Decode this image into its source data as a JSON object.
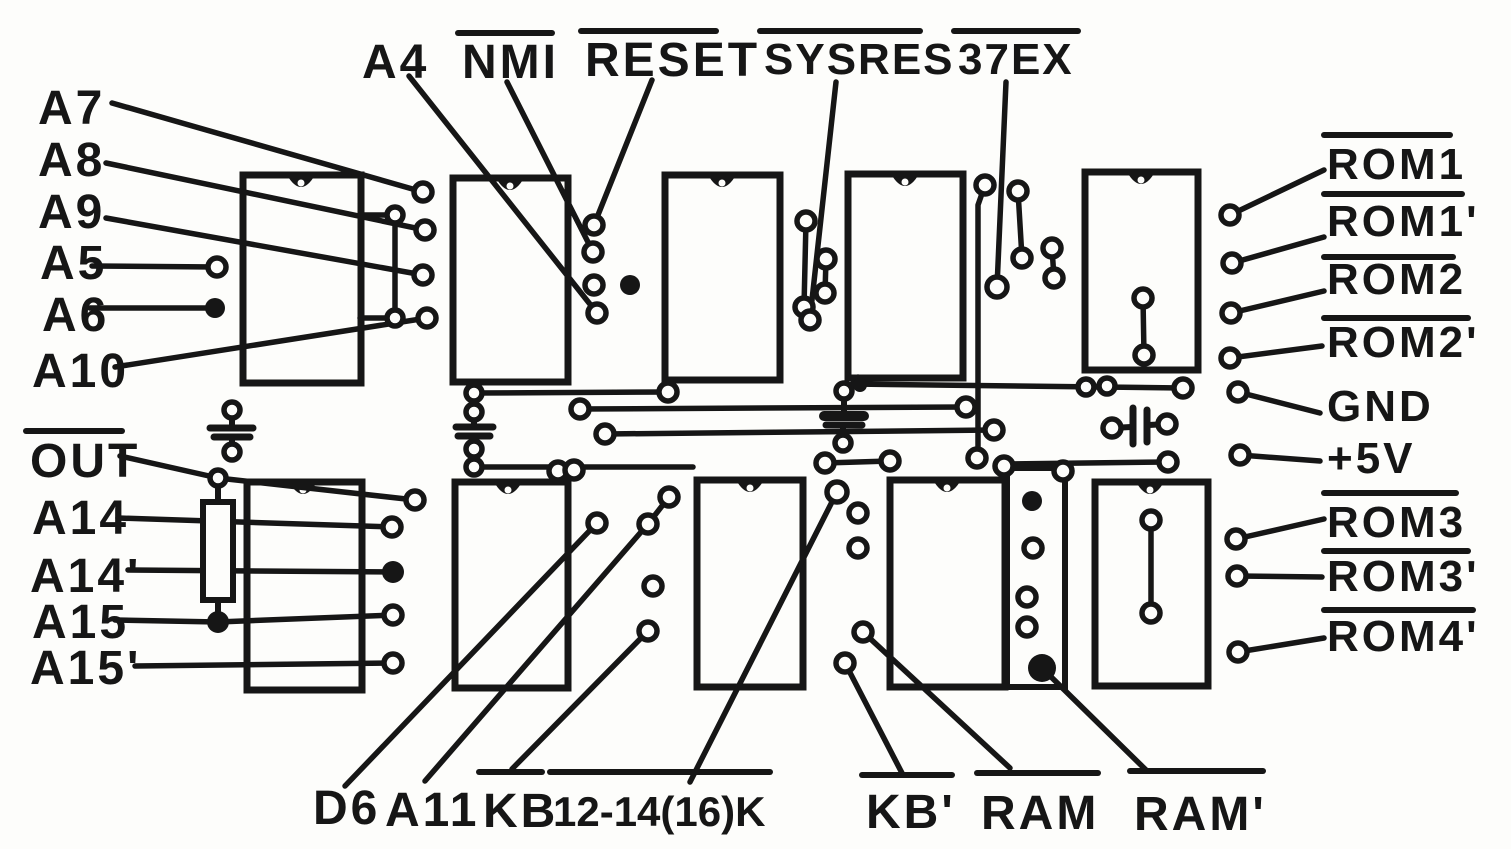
{
  "diagram": {
    "type": "hand-drawn PCB wiring schematic",
    "ink_color": "#161616",
    "paper_color": "#fdfdfb",
    "labels": {
      "a7": "A7",
      "a8": "A8",
      "a9": "A9",
      "a5": "A5",
      "a6": "A6",
      "a10": "A10",
      "a4": "A4",
      "nmi": "NMI",
      "reset": "RESET",
      "sysres": "SYSRES",
      "ex37": "37EX",
      "rom1": "ROM1",
      "rom1p": "ROM1'",
      "rom2": "ROM2",
      "rom2p": "ROM2'",
      "gnd": "GND",
      "p5v": "+5V",
      "rom3": "ROM3",
      "rom3p": "ROM3'",
      "rom4p": "ROM4'",
      "out": "OUT",
      "a14": "A14",
      "a14p": "A14'",
      "a15": "A15",
      "a15p": "A15'",
      "d6": "D6",
      "a11": "A11",
      "kb": "KB",
      "k1214": "12-14(16)K",
      "kbp": "KB'",
      "ram": "RAM",
      "ramp": "RAM'"
    },
    "overlined_signals": [
      "NMI",
      "RESET",
      "SYSRES",
      "37EX",
      "ROM1",
      "ROM1'",
      "ROM2",
      "ROM2'",
      "ROM3",
      "ROM3'",
      "ROM4'",
      "OUT",
      "KB",
      "12-14(16)K",
      "KB'",
      "RAM",
      "RAM'"
    ],
    "component_counts": {
      "ic_outlines": 10,
      "narrow_outline": 1,
      "capacitors": 4,
      "resistors": 1
    }
  }
}
